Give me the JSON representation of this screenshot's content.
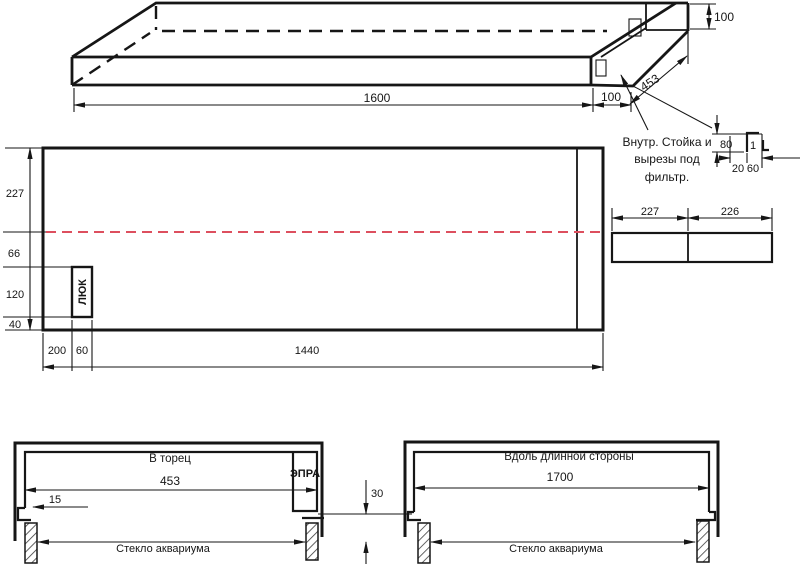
{
  "drawing": {
    "iso": {
      "dim_length": "1600",
      "dim_end_offset": "100",
      "dim_height": "100",
      "dim_depth": "453",
      "note1": "Внутр. Стойка и",
      "note2": "вырезы под",
      "note3": "фильтр."
    },
    "stand_detail": {
      "dim_height": "80",
      "dim_gap": "1",
      "dim_a": "20",
      "dim_b": "60"
    },
    "front": {
      "dim_row1": "227",
      "dim_row2": "66",
      "dim_row3": "120",
      "dim_row4": "40",
      "hatch_label": "ЛЮК",
      "dim_b1": "200",
      "dim_b2": "60",
      "dim_b3": "1440"
    },
    "panel": {
      "dim_left": "227",
      "dim_right": "226"
    },
    "section_end": {
      "title": "В торец",
      "dim_width": "453",
      "dim_lip": "15",
      "ballast": "ЭПРА",
      "glass": "Стекло аквариума"
    },
    "section_long": {
      "title": "Вдоль длинной стороны",
      "dim_width": "1700",
      "glass": "Стекло аквариума"
    },
    "gap": {
      "dim": "30"
    },
    "colors": {
      "red_line": "#dd4f5e"
    }
  }
}
